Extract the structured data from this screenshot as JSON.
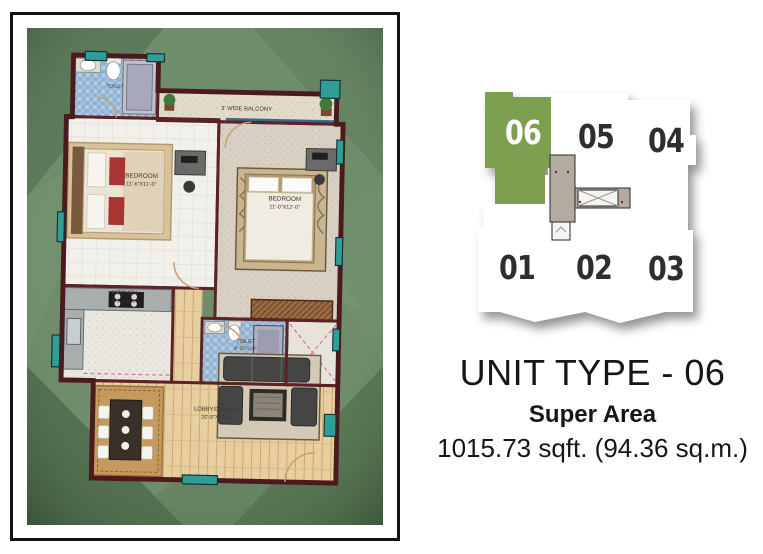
{
  "info": {
    "title": "UNIT TYPE - 06",
    "subtitle": "Super Area",
    "area": "1015.73 sqft. (94.36 sq.m.)"
  },
  "keyplan": {
    "highlighted_unit": "06",
    "highlight_color": "#7da050",
    "units_top": [
      "06",
      "05",
      "04"
    ],
    "units_bottom": [
      "01",
      "02",
      "03"
    ]
  },
  "floorplan": {
    "balcony_label": "3' WIDE BALCONY",
    "rooms": [
      {
        "name": "TOILET",
        "dims": ""
      },
      {
        "name": "BEDROOM",
        "dims": "11'-6\"X11'-0\""
      },
      {
        "name": "BEDROOM",
        "dims": "11'-0\"X12'-0\""
      },
      {
        "name": "KITCHEN",
        "dims": "8'-3\"X10'-0\""
      },
      {
        "name": "TOILET",
        "dims": "8'-0\"X5'-0\""
      },
      {
        "name": "LOBBY/DINNING",
        "dims": "20'-8\"X12'-0\""
      }
    ],
    "colors": {
      "wall_maroon": "#5b2326",
      "accent_teal": "#2f9e94",
      "background_green": "#6f8d6b",
      "wood_floor": "#e8cfa0"
    }
  }
}
